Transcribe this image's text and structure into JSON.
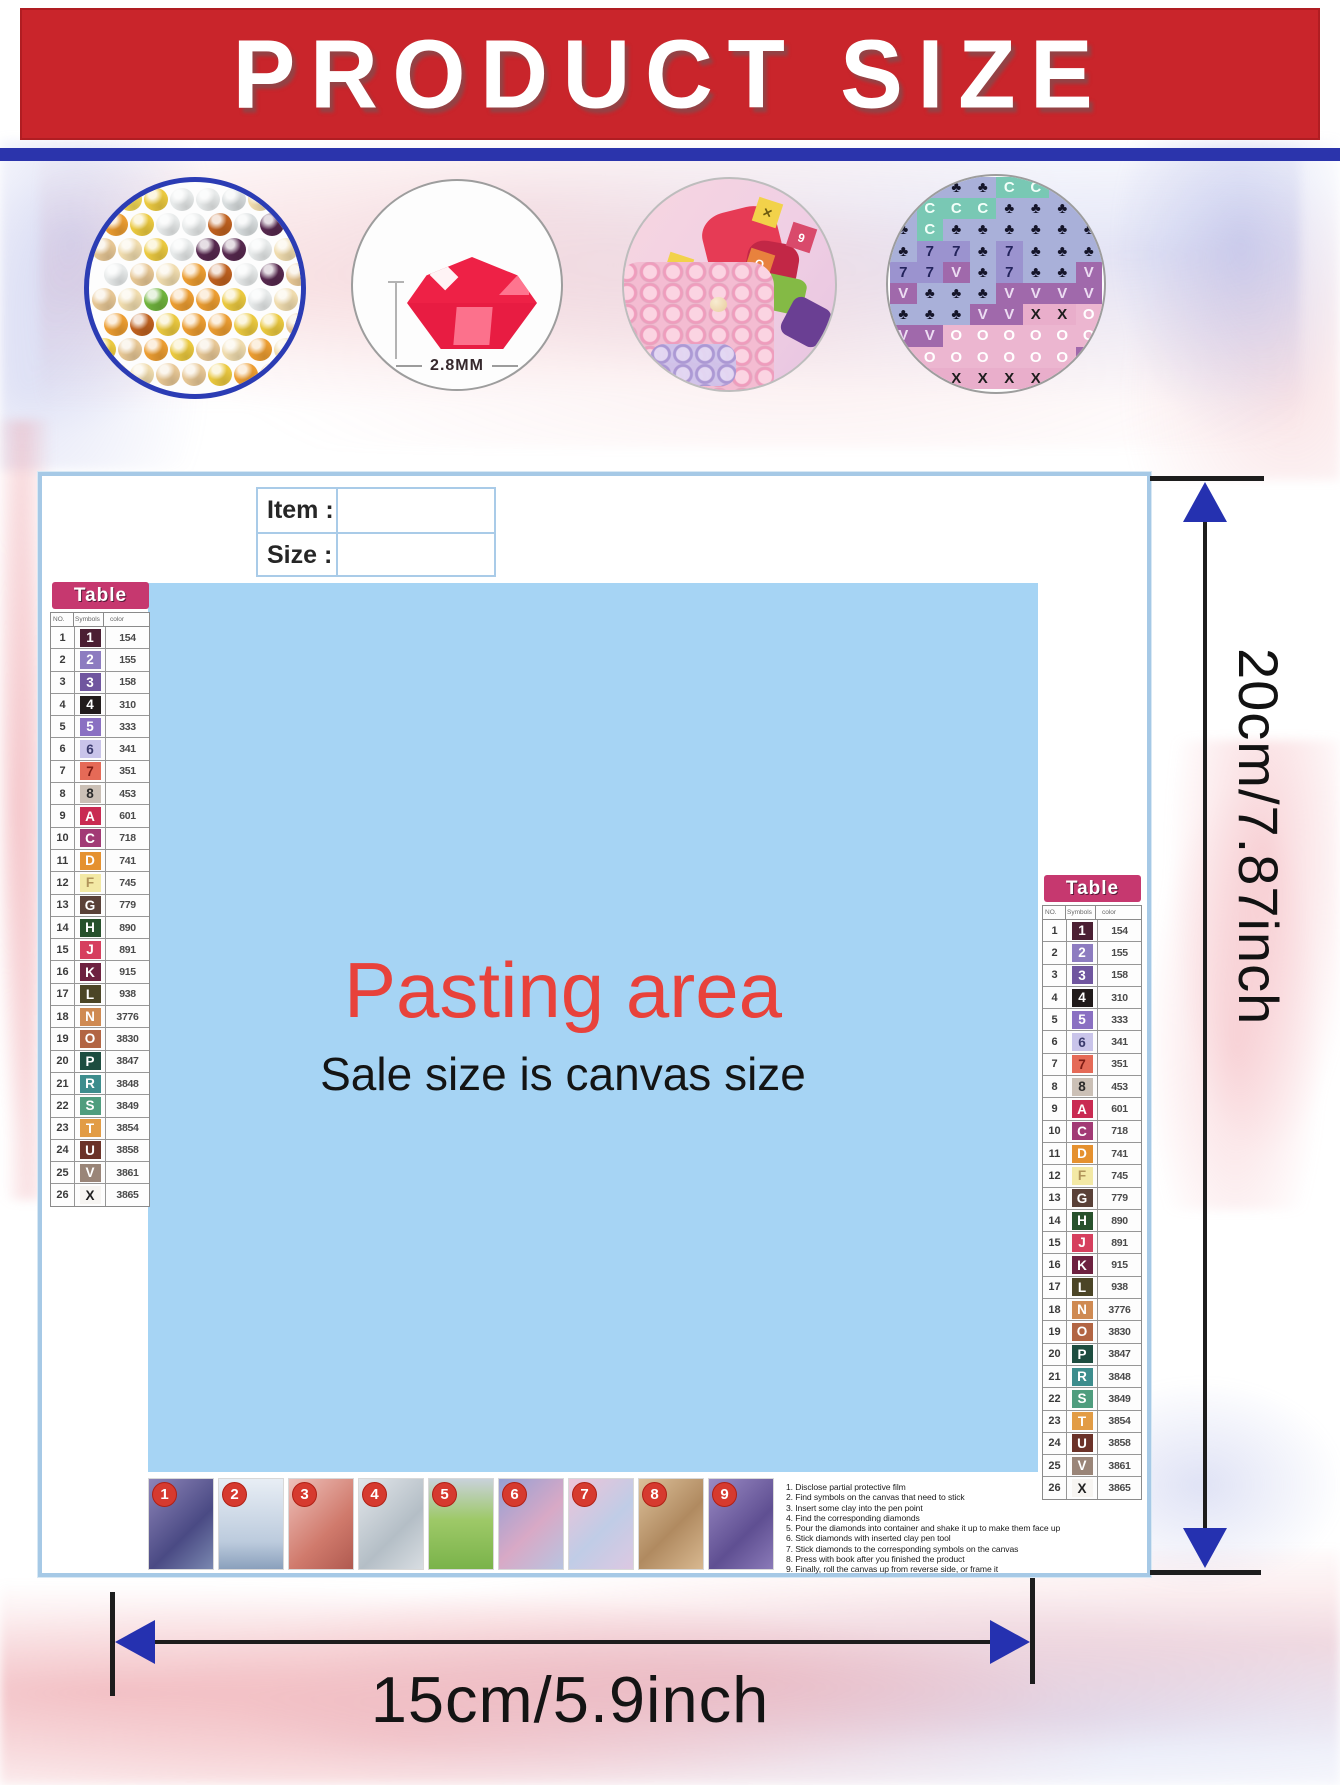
{
  "banner": {
    "title": "PRODUCT SIZE"
  },
  "circles": {
    "gem_size_label": "2.8MM"
  },
  "item_box": {
    "item_label": "Item :",
    "size_label": "Size :"
  },
  "pasting": {
    "title": "Pasting area",
    "subtitle": "Sale size is canvas size"
  },
  "dimensions": {
    "vertical": "20cm/7.87inch",
    "horizontal": "15cm/5.9inch"
  },
  "colors": {
    "banner_red": "#c9252b",
    "divider_blue": "#2b34ac",
    "arrow_blue": "#2531b0",
    "pasting_blue": "#a6d4f4",
    "table_pill_magenta": "#c6386f",
    "pasting_title_red": "#e8423b",
    "step_badge_red": "#d63a2f"
  },
  "color_table": {
    "title": "Table",
    "headers": [
      "NO.",
      "Symbols",
      "color"
    ],
    "rows": [
      {
        "no": "1",
        "symbol": "1",
        "code": "154",
        "bg": "#4b1f33",
        "fg": "#ffffff"
      },
      {
        "no": "2",
        "symbol": "2",
        "code": "155",
        "bg": "#8d7cc0",
        "fg": "#ffffff"
      },
      {
        "no": "3",
        "symbol": "3",
        "code": "158",
        "bg": "#70569f",
        "fg": "#ffffff"
      },
      {
        "no": "4",
        "symbol": "4",
        "code": "310",
        "bg": "#211b1b",
        "fg": "#ffffff"
      },
      {
        "no": "5",
        "symbol": "5",
        "code": "333",
        "bg": "#8a70c2",
        "fg": "#ffffff"
      },
      {
        "no": "6",
        "symbol": "6",
        "code": "341",
        "bg": "#c9c4ea",
        "fg": "#3b3b6e"
      },
      {
        "no": "7",
        "symbol": "7",
        "code": "351",
        "bg": "#e56a57",
        "fg": "#7e1c14"
      },
      {
        "no": "8",
        "symbol": "8",
        "code": "453",
        "bg": "#cbc0b6",
        "fg": "#2b2b2b"
      },
      {
        "no": "9",
        "symbol": "A",
        "code": "601",
        "bg": "#c92a52",
        "fg": "#ffffff"
      },
      {
        "no": "10",
        "symbol": "C",
        "code": "718",
        "bg": "#a23a75",
        "fg": "#ffffff"
      },
      {
        "no": "11",
        "symbol": "D",
        "code": "741",
        "bg": "#e5912f",
        "fg": "#ffffff"
      },
      {
        "no": "12",
        "symbol": "F",
        "code": "745",
        "bg": "#f3e9a5",
        "fg": "#b1955a"
      },
      {
        "no": "13",
        "symbol": "G",
        "code": "779",
        "bg": "#5a4138",
        "fg": "#ffffff"
      },
      {
        "no": "14",
        "symbol": "H",
        "code": "890",
        "bg": "#27512c",
        "fg": "#ffffff"
      },
      {
        "no": "15",
        "symbol": "J",
        "code": "891",
        "bg": "#d63f5e",
        "fg": "#ffffff"
      },
      {
        "no": "16",
        "symbol": "K",
        "code": "915",
        "bg": "#6d2140",
        "fg": "#ffffff"
      },
      {
        "no": "17",
        "symbol": "L",
        "code": "938",
        "bg": "#4b4526",
        "fg": "#ffffff"
      },
      {
        "no": "18",
        "symbol": "N",
        "code": "3776",
        "bg": "#cf8a52",
        "fg": "#ffffff"
      },
      {
        "no": "19",
        "symbol": "O",
        "code": "3830",
        "bg": "#b26543",
        "fg": "#ffffff"
      },
      {
        "no": "20",
        "symbol": "P",
        "code": "3847",
        "bg": "#1d4d40",
        "fg": "#ffffff"
      },
      {
        "no": "21",
        "symbol": "R",
        "code": "3848",
        "bg": "#3d8d8d",
        "fg": "#ffffff"
      },
      {
        "no": "22",
        "symbol": "S",
        "code": "3849",
        "bg": "#4f9d7e",
        "fg": "#ffffff"
      },
      {
        "no": "23",
        "symbol": "T",
        "code": "3854",
        "bg": "#e29c45",
        "fg": "#ffffff"
      },
      {
        "no": "24",
        "symbol": "U",
        "code": "3858",
        "bg": "#6b3228",
        "fg": "#ffffff"
      },
      {
        "no": "25",
        "symbol": "V",
        "code": "3861",
        "bg": "#9a8578",
        "fg": "#ffffff"
      },
      {
        "no": "26",
        "symbol": "X",
        "code": "3865",
        "bg": "#f7f5f2",
        "fg": "#1f1f1f"
      }
    ]
  },
  "steps": {
    "numbers": [
      "1",
      "2",
      "3",
      "4",
      "5",
      "6",
      "7",
      "8",
      "9"
    ],
    "instructions": [
      "1. Disclose partial protective film",
      "2. Find symbols on the canvas that need to stick",
      "3. Insert some clay into the pen point",
      "4. Find the corresponding diamonds",
      "5. Pour the diamonds into container and shake it up to make them face up",
      "6. Stick diamonds with inserted clay pen tool",
      "7. Stick diamonds to the corresponding symbols on the canvas",
      "8. Press with book after you finished the product",
      "9. Finally, roll the canvas up from reverse side, or frame it"
    ]
  },
  "diamond_circle": {
    "palette": [
      "#ebc93f",
      "#ec9d31",
      "#e7eaea",
      "#f0dcae",
      "#56284e",
      "#6fb33c",
      "#bf611f",
      "#d9dedf",
      "#e7c795",
      "#f3d855"
    ],
    "rows": [
      "09022733",
      "10226743",
      "83024423",
      "28316248",
      "83511023",
      "16011008",
      "08108313",
      "33880188"
    ]
  },
  "symbol_circle": {
    "palette": [
      {
        "bg": "#a9b0d9",
        "fg": "#15152a"
      },
      {
        "bg": "#79c8b4",
        "fg": "#f2fff9"
      },
      {
        "bg": "#9b93cf",
        "fg": "#23235c"
      },
      {
        "bg": "#a069ab",
        "fg": "#ecdcf2"
      },
      {
        "bg": "#ecb6d0",
        "fg": "#ffffff"
      },
      {
        "bg": "#e9aecb",
        "fg": "#1d1d1d"
      },
      {
        "bg": "#4f6fc4",
        "fg": "#ffffff"
      }
    ],
    "rows": [
      {
        "chars": "♣♣♣♣CC♣♣",
        "colors": "00001100"
      },
      {
        "chars": "♣CCC♣♣♣♣",
        "colors": "01110000"
      },
      {
        "chars": "♣C♣♣♣♣♣♣",
        "colors": "01000000"
      },
      {
        "chars": "♣77♣7♣♣♣",
        "colors": "02202000"
      },
      {
        "chars": "77V♣7♣♣V",
        "colors": "22302003"
      },
      {
        "chars": "V♣♣♣VVVV",
        "colors": "30003333"
      },
      {
        "chars": "♣♣♣VVXXO",
        "colors": "00033554"
      },
      {
        "chars": "VVOOOOOO",
        "colors": "33444444"
      },
      {
        "chars": "OOOOOOOV",
        "colors": "44444443"
      },
      {
        "chars": "XXXXXXXY",
        "colors": "55555556"
      }
    ]
  }
}
